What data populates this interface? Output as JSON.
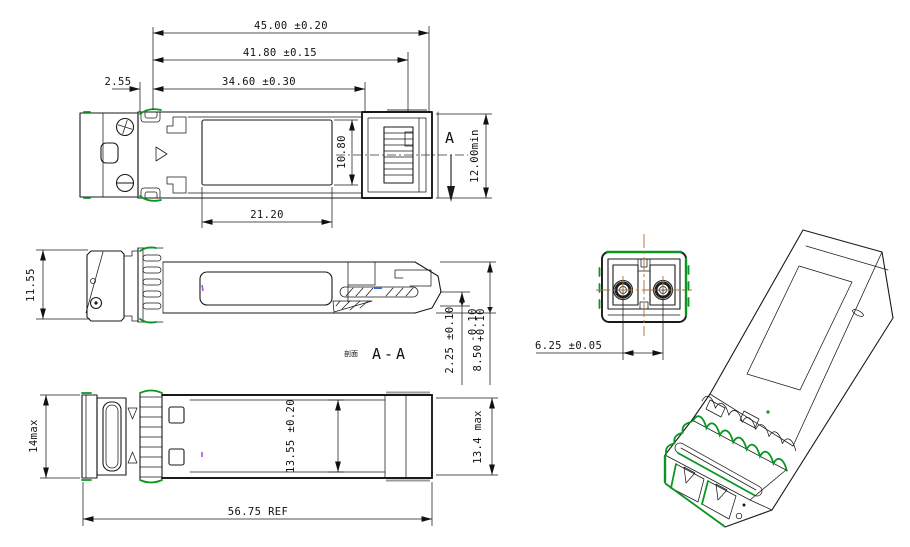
{
  "labels": {
    "d_45": "45.00 ±0.20",
    "d_41": "41.80 ±0.15",
    "d_34": "34.60 ±0.30",
    "d_2_55": "2.55",
    "d_21": "21.20",
    "d_10_8": "10.80",
    "d_12min": "12.00min",
    "section_letter": "A",
    "d_11_55": "11.55",
    "section_prefix": "剖面",
    "section_name": "A-A",
    "d_2_25": "2.25 ±0.10",
    "d_8_5": "8.50",
    "d_8_5_tp": "+0.10",
    "d_8_5_tm": "-0.10",
    "d_14max": "14max",
    "d_13_55": "13.55 ±0.20",
    "d_13_4": "13.4 max",
    "d_56_75": "56.75 REF",
    "d_6_25": "6.25 ±0.05"
  },
  "colors": {
    "line": "#1a1a1a",
    "accent_green": "#0a9622",
    "centerline_orange": "#ad7032",
    "highlight_blue": "#3b66e8",
    "mark_purple": "#a855d8",
    "shade_gray": "#9b9b9b",
    "background": "#ffffff"
  }
}
